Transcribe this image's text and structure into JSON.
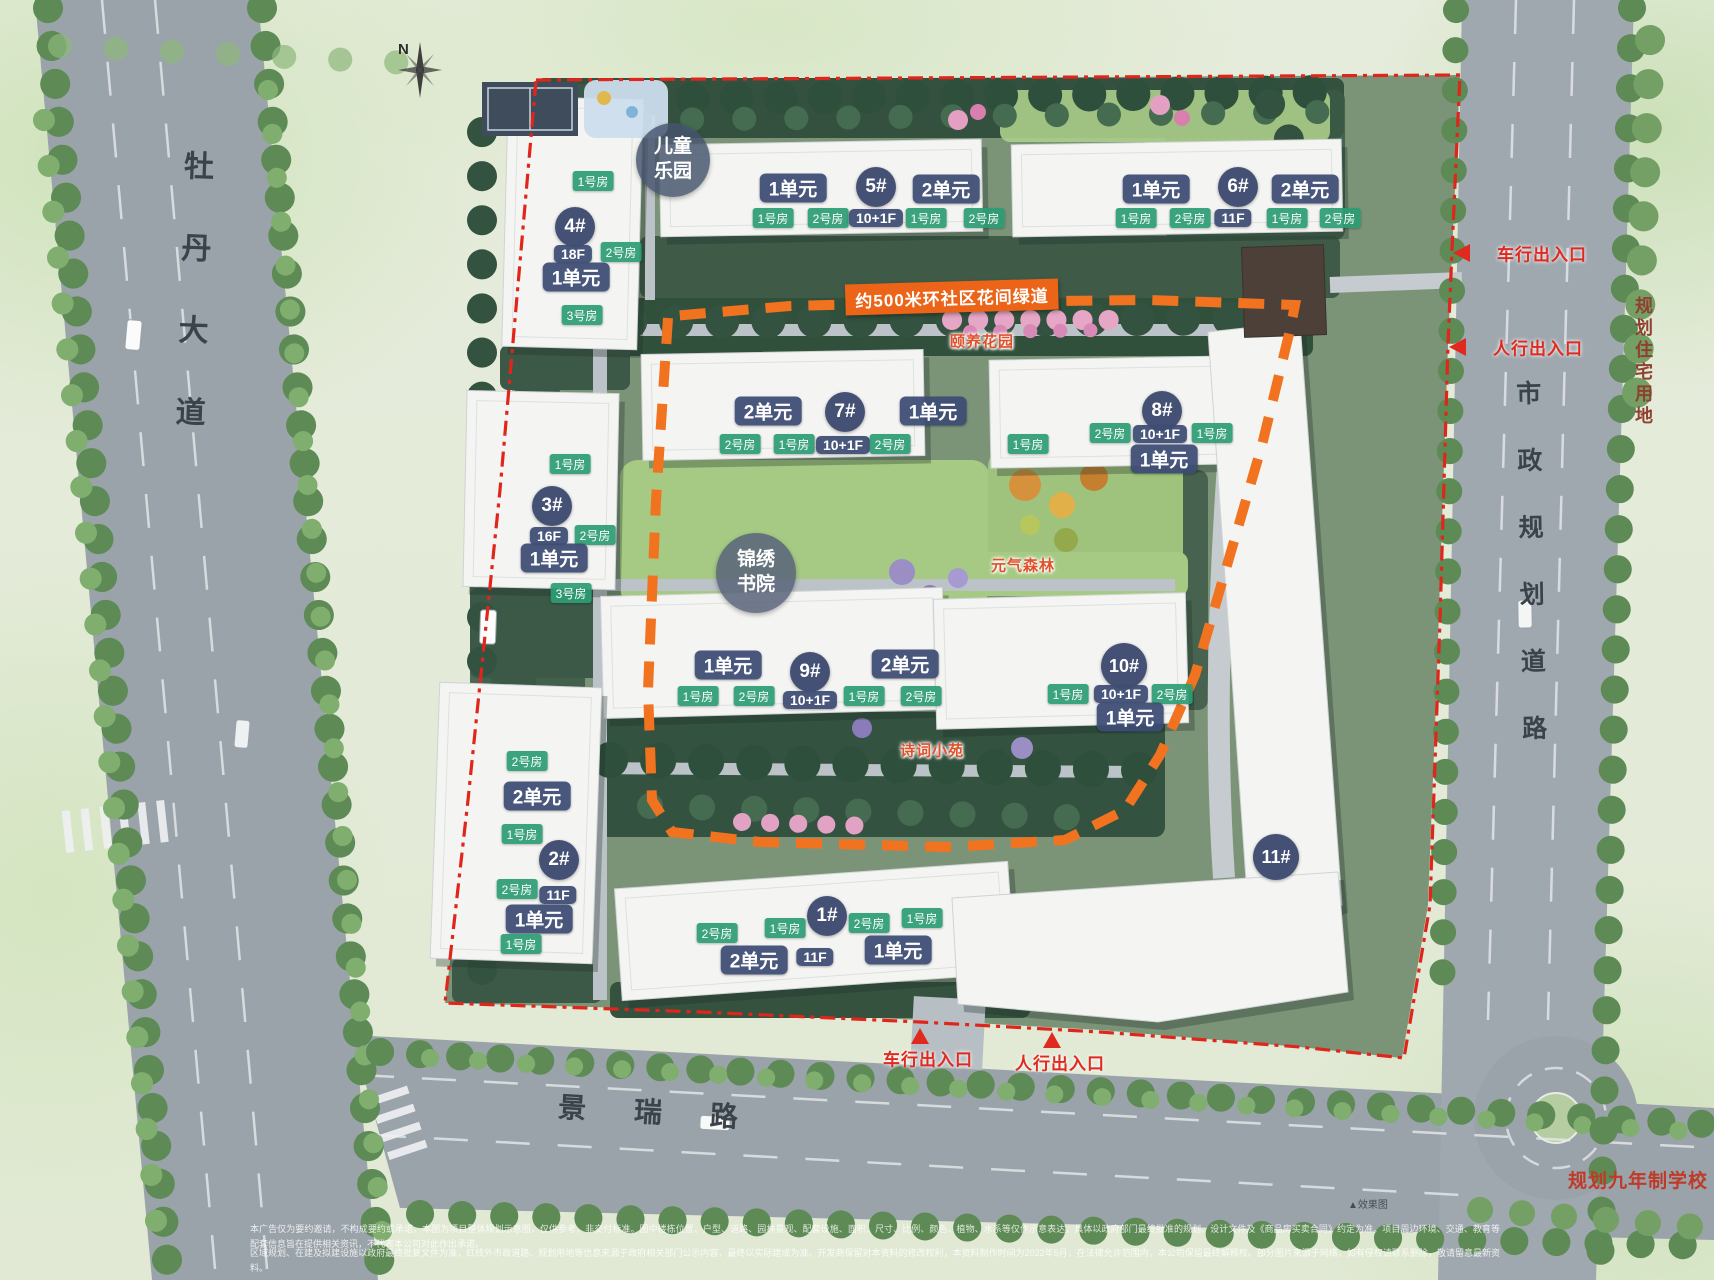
{
  "map": {
    "compass": "N",
    "banner": "约500米环社区花间绿道",
    "places": {
      "kids1": "儿童",
      "kids2": "乐园",
      "study1": "锦绣",
      "study2": "书院",
      "garden": "颐养花园",
      "forest": "元气森林",
      "poetry": "诗词小苑"
    },
    "roads": {
      "west": "牡丹大道",
      "south": "景瑞路",
      "east": "市政规划道路"
    },
    "zones": {
      "residential": "规划住宅用地",
      "school": "规划九年制学校"
    },
    "entrances": {
      "vehicle": "车行出入口",
      "pedestrian": "人行出入口"
    },
    "note": "▲效果图",
    "disclaimer1": "本广告仅为要约邀请，不构成要约或承诺。本图为项目整体规划示意图，仅供参考，非交付标准。图中楼栋位置、户型、道路、园林景观、配套设施、面积、尺寸、比例、颜色、植物、水系等仅作示意表达，具体以政府部门最终批准的规划、设计文件及《商品房买卖合同》约定为准。项目周边环境、交通、教育等配套信息旨在提供相关资讯，不代表本公司对此作出承诺。",
    "disclaimer2": "区域规划、在建及拟建设施以政府最终批复文件为准，红线外市政道路、规划用地等信息来源于政府相关部门公示内容，最终以实际建成为准。开发商保留对本资料的修改权利，本资料制作时间为2022年5月，在法律允许范围内，本公司保留最终解释权。部分图片来源于网络，如有侵权请联系删除，敬请留意最新资料。"
  },
  "labels": {
    "unit1": "1单元",
    "unit2": "2单元",
    "room1": "1号房",
    "room2": "2号房",
    "room3": "3号房"
  },
  "buildings": {
    "b1": {
      "no": "1#",
      "floor": "11F"
    },
    "b2": {
      "no": "2#",
      "floor": "11F"
    },
    "b3": {
      "no": "3#",
      "floor": "16F"
    },
    "b4": {
      "no": "4#",
      "floor": "18F"
    },
    "b5": {
      "no": "5#",
      "floor": "10+1F"
    },
    "b6": {
      "no": "6#",
      "floor": "11F"
    },
    "b7": {
      "no": "7#",
      "floor": "10+1F"
    },
    "b8": {
      "no": "8#",
      "floor": "10+1F"
    },
    "b9": {
      "no": "9#",
      "floor": "10+1F"
    },
    "b10": {
      "no": "10#",
      "floor": "10+1F"
    },
    "b11": {
      "no": "11#"
    }
  },
  "colors": {
    "boundary_red": "#e0251b",
    "greenway_orange": "#f2731f",
    "badge_navy": "#3e4c74",
    "room_tag_green": "#2c9c74",
    "accent_orange": "#e0502a",
    "entrance_red": "#e02a20"
  }
}
